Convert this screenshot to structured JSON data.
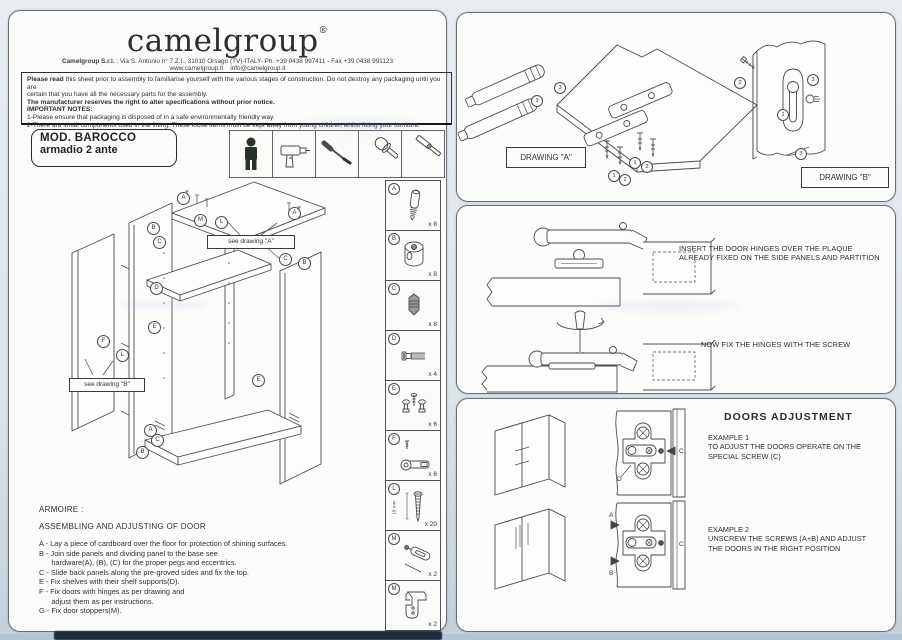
{
  "colors": {
    "paper": "#fcfcfa",
    "background": "#dde4ea",
    "ink": "#3b3b3b",
    "dark_bar": "#212c3a",
    "person_icon": "#2a332a"
  },
  "header": {
    "logo": "camelgroup",
    "registered": "®",
    "address_bold": "Camelgroup S.r.l.",
    "address_rest": " : Via S. Antonio n° 7 Z.I., 31010 Orsago (TV)-ITALY- Ph. +39 0438 997411 - Fax +39 0438 991123",
    "web": "www.camelgroup.it",
    "email": "info@camelgroup.it"
  },
  "notice": {
    "lead": "Please read",
    "line1_rest": " this sheet prior to assembly to familiarise yourself with the various stages of construction. Do not destroy any packaging until you are",
    "line2": "certain that you have all the necessary parts for the assembly.",
    "line3": "The manufacturer reserves the right to alter specifications without prior notice.",
    "line4": "IMPORTANT NOTES:",
    "line5": "1-Please ensure that packaging is disposed of in a safe environmentally friendly way.",
    "line6": "2-There are small components used in the fitting. These loose items must be kept away from young children whilst fitting your furniture."
  },
  "model": {
    "line1": "MOD.  BAROCCO",
    "line2": "armadio 2 ante"
  },
  "tools": [
    "person-icon",
    "drill-icon",
    "screwdriver-icon",
    "mallet-icon",
    "hammer-icon"
  ],
  "diagram": {
    "see_a": "see drawing \"A\"",
    "see_b": "see drawing \"B\"",
    "callouts": [
      "A",
      "A",
      "M",
      "L",
      "B",
      "C",
      "C",
      "B",
      "D",
      "E",
      "F",
      "L",
      "E",
      "A",
      "C",
      "B"
    ]
  },
  "parts": {
    "items": [
      {
        "letter": "A",
        "qty": "x 8"
      },
      {
        "letter": "B",
        "qty": "x 8"
      },
      {
        "letter": "C",
        "qty": "x 8"
      },
      {
        "letter": "D",
        "qty": "x 4"
      },
      {
        "letter": "E",
        "qty": "x 6"
      },
      {
        "letter": "F",
        "qty": "x 6"
      },
      {
        "letter": "L",
        "qty": "x 20",
        "dim": "18 mm"
      },
      {
        "letter": "M",
        "qty": "x 2"
      },
      {
        "letter": "M",
        "qty": "x 2"
      }
    ]
  },
  "instructions": {
    "title": "ARMOIRE :",
    "subtitle": "ASSEMBLING AND ADJUSTING OF DOOR",
    "lines": [
      "A - Lay a piece of cardboard over the floor for protection of shining surfaces.",
      "B - Join side panels and dividing panel to the base see",
      "      hardware(A), (B), (C) for the proper pegs and eccentrics.",
      "C - Slide back panels along the pre-groved sides and fix the top.",
      "E - Fix shelves with their shelf supports(D).",
      "F - Fix doors with hinges as per drawing and",
      "      adjust them as per instructions.",
      "G - Fix door stoppers(M)."
    ]
  },
  "drawing_a": {
    "label": "DRAWING \"A\"",
    "callouts": [
      "3",
      "3",
      "1",
      "2",
      "1",
      "2"
    ]
  },
  "drawing_b": {
    "label": "DRAWING \"B\"",
    "callouts": [
      "2",
      "1",
      "3",
      "3"
    ]
  },
  "hinges": {
    "text1a": "INSERT THE DOOR HINGES OVER THE PLAQUE",
    "text1b": "ALREADY FIXED ON THE SIDE PANELS AND PARTITION",
    "text2": "NOW FIX THE HINGES WITH THE SCREW"
  },
  "adjustment": {
    "title": "DOORS ADJUSTMENT",
    "ex1_title": "EXAMPLE 1",
    "ex1_line1": "TO ADJUST THE DOORS OPERATE ON THE",
    "ex1_line2": "SPECIAL SCREW  (C)",
    "ex2_title": "EXAMPLE  2",
    "ex2_line1": "UNSCREW THE SCREWS (A+B) AND ADJUST",
    "ex2_line2": "THE DOORS IN THE RIGHT POSITION",
    "plate1_labels": {
      "c": "C",
      "d": "D"
    },
    "plate2_labels": {
      "a": "A",
      "b": "B",
      "c": "C"
    }
  }
}
